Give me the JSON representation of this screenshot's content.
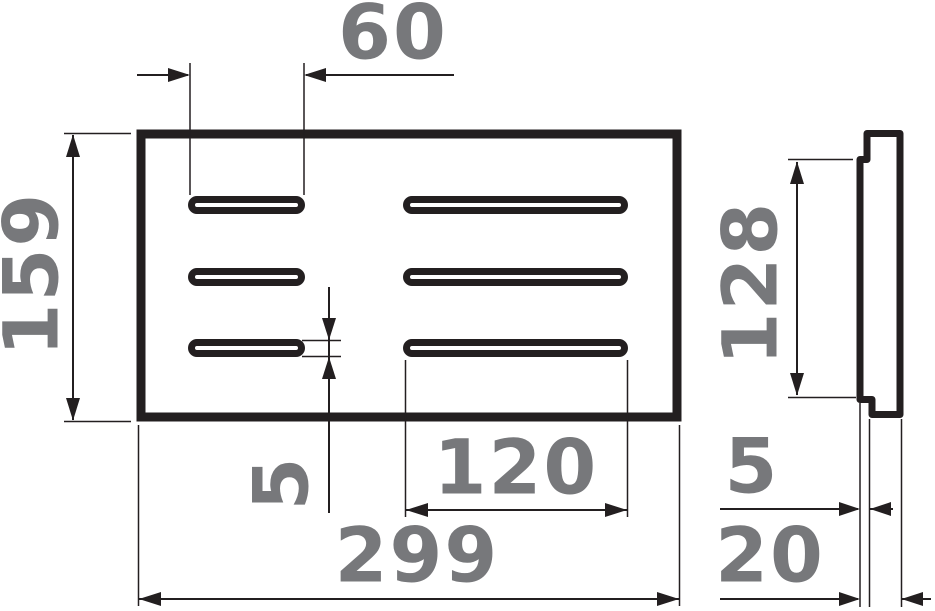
{
  "drawing": {
    "type": "technical-dimension-drawing",
    "background": "#ffffff",
    "line_color": "#231f20",
    "label_color": "#77787b",
    "views": {
      "front_view": "perforated plate with six slots (two columns, three rows)",
      "side_view": "plate profile with raised lip"
    },
    "dimensions": {
      "top_slot_length": "60",
      "overall_height": "159",
      "slot_height": "5",
      "long_slot_length": "120",
      "overall_width": "299",
      "lip_height": "128",
      "lip_depth": "5",
      "overall_depth": "20"
    }
  }
}
